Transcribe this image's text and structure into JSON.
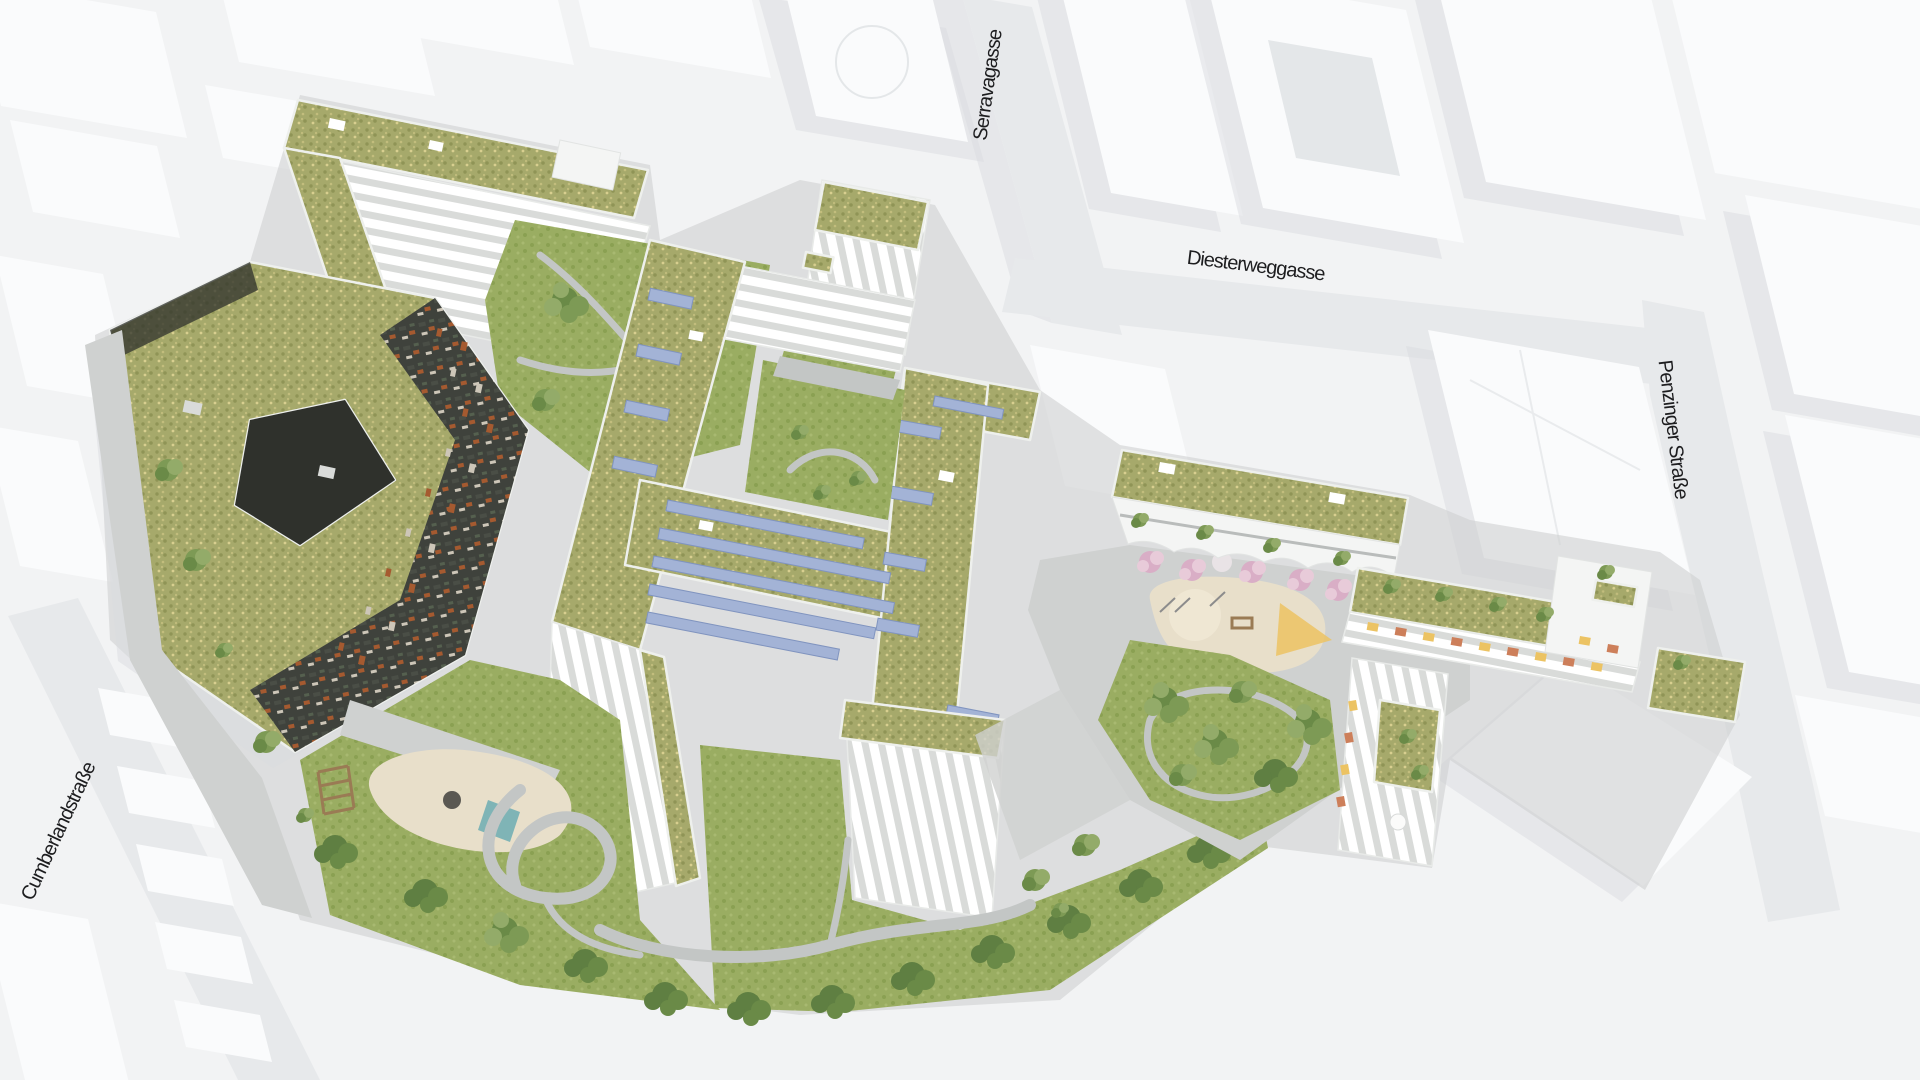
{
  "scene": {
    "type": "aerial-architectural-rendering",
    "description": "Aerial rendering of a residential quarter with green meadow roofs, solar panels, courtyards, playground and gardens, embedded in abstract white city massing"
  },
  "street_labels": {
    "serravagasse": "Serravagasse",
    "diesterweggasse": "Diesterweggasse",
    "penzinger_strasse": "Penzinger Straße",
    "cumberlandstrasse": "Cumberlandstraße"
  },
  "palette": {
    "ground": "#f2f3f4",
    "street": "#e7e9eb",
    "block": "#fafbfc",
    "blockside": "#e4e7e9",
    "shadow": "#d9dcdf",
    "roofgreen": "#a6a96b",
    "roofgreen2": "#8f9456",
    "roofgreen3": "#c2bd7d",
    "lawn": "#9aad62",
    "lawn2": "#8aa052",
    "tree1": "#7d9a55",
    "tree2": "#6a8a47",
    "tree3": "#93ab69",
    "treedark": "#5f7f42",
    "paving": "#cfd1d0",
    "paving2": "#c3c6c5",
    "white": "#f4f5f4",
    "terrace": "#d9dbd9",
    "dark": "#3f423c",
    "dark2": "#2f312c",
    "accentorange": "#a55a30",
    "accentterracotta": "#cd7f5a",
    "accentyellow": "#ecc363",
    "pv": "#a3b3d6",
    "pvedge": "#8094bf",
    "sand": "#e8dfca",
    "sand2": "#efe7d3",
    "pool": "#7fb4b6",
    "blossom": "#d9aec6",
    "blossom2": "#e8cbd9",
    "wood": "#9a7b54",
    "label": "#1d1d1f"
  }
}
